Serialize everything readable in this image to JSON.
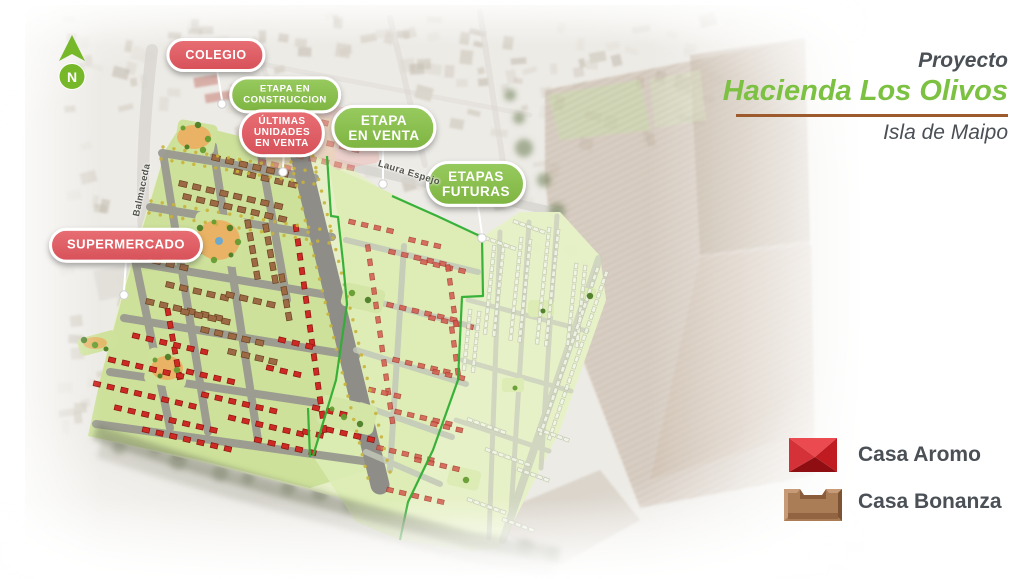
{
  "project": {
    "kicker": "Proyecto",
    "name": "Hacienda Los Olivos",
    "location": "Isla de Maipo"
  },
  "north": {
    "label": "N"
  },
  "annotations": {
    "colegio": {
      "label": "COLEGIO",
      "type": "red"
    },
    "etapa_construccion": {
      "label": "ETAPA EN\nCONSTRUCCION",
      "type": "green"
    },
    "ultimas_unidades": {
      "label": "ÚLTIMAS\nUNIDADES\nEN VENTA",
      "type": "red"
    },
    "etapa_venta": {
      "label": "ETAPA\nEN VENTA",
      "type": "green"
    },
    "etapas_futuras": {
      "label": "ETAPAS\nFUTURAS",
      "type": "green"
    },
    "supermercado": {
      "label": "SUPERMERCADO",
      "type": "red"
    }
  },
  "streets": {
    "balmaceda": "Balmaceda",
    "laura_espejo": "Laura Espejo"
  },
  "legend": {
    "items": [
      {
        "id": "casa-aromo",
        "label": "Casa Aromo",
        "color": "#c42127"
      },
      {
        "id": "casa-bonanza",
        "label": "Casa Bonanza",
        "color": "#a87a55"
      }
    ]
  },
  "colors": {
    "brand_green": "#7cc142",
    "pill_green": "#8cc051",
    "pill_red": "#e0646a",
    "rule_brown": "#9d5b2d",
    "text_dark": "#4a5056",
    "boundary_green": "#2fae33",
    "aromo_red": "#ce2a24",
    "bonanza_brown": "#9c6b46"
  }
}
